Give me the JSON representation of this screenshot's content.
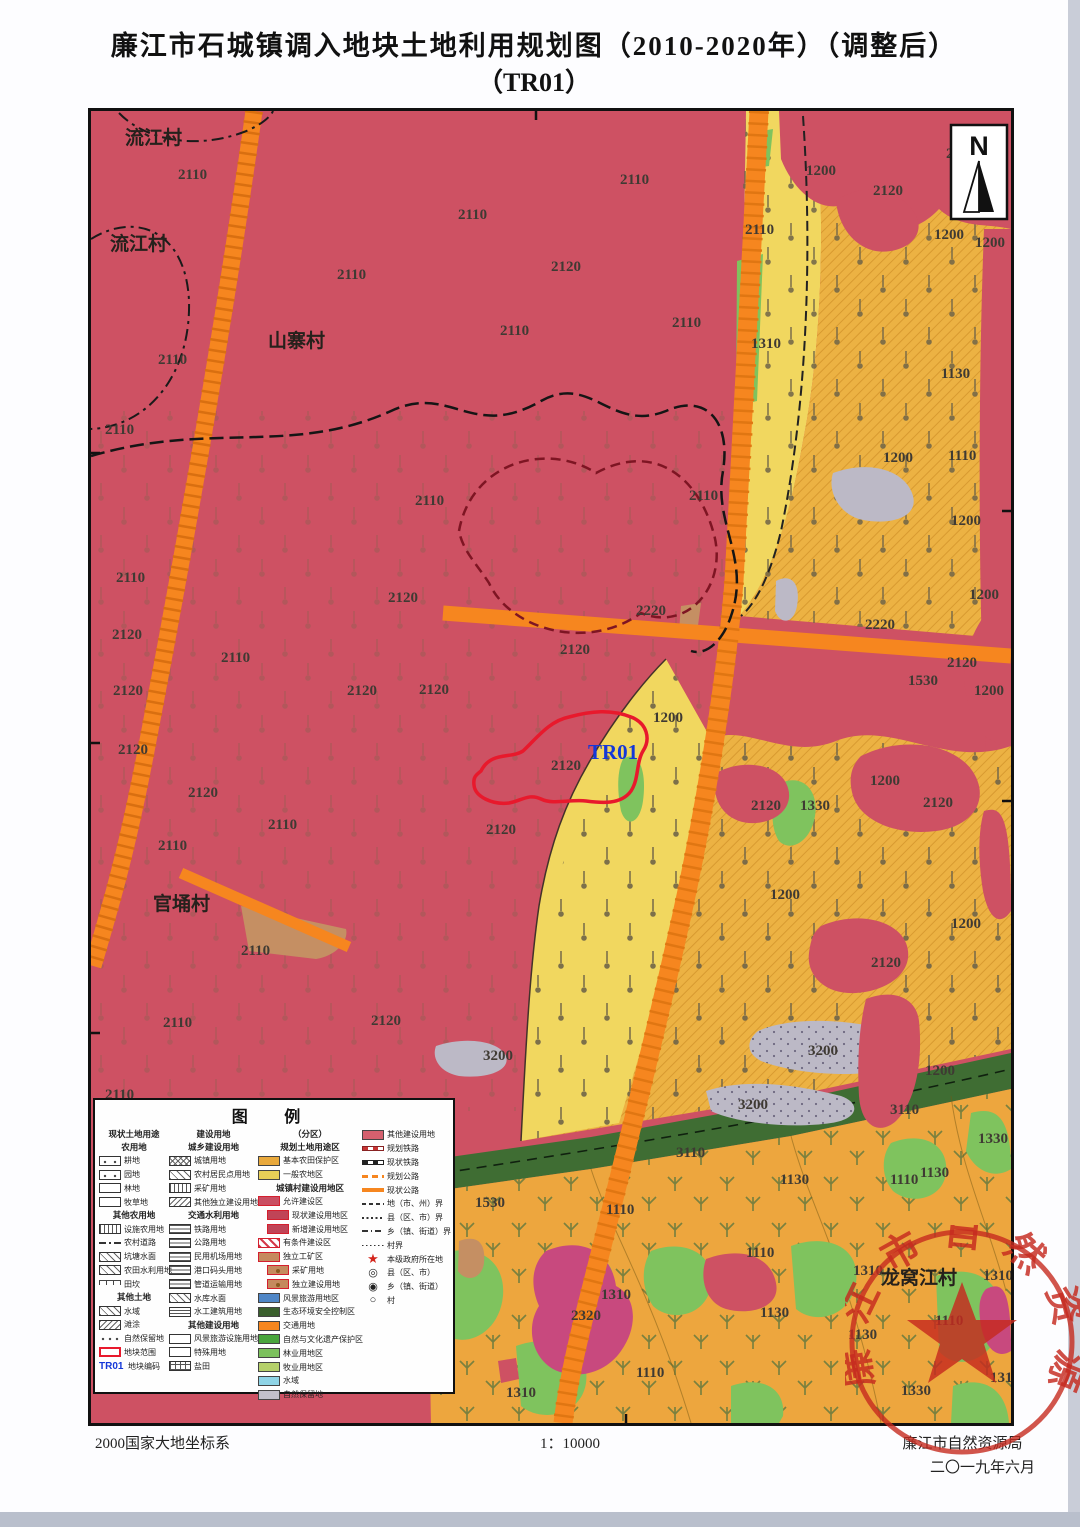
{
  "page": {
    "title_line1": "廉江市石城镇调入地块土地利用规划图（2010-2020年）（调整后）",
    "title_line2": "（TR01）"
  },
  "footer": {
    "coordinate_system": "2000国家大地坐标系",
    "scale": "1：10000",
    "agency": "廉江市自然资源局",
    "date": "二〇一九年六月"
  },
  "seal": {
    "ring_text": "廉江市自然资源局"
  },
  "north": {
    "label": "N"
  },
  "colors": {
    "base_red": "#ce5163",
    "golden": "#ecb243",
    "light_yellow": "#f1d75f",
    "bottom_gold": "#eda63e",
    "road_orange": "#f6861f",
    "green": "#7fc35e",
    "dark_green": "#3f6d33",
    "gray": "#bcb9c6",
    "magenta": "#c8497e",
    "tan": "#c58f63",
    "plot_red": "#e8192c",
    "plot_code_blue": "#1437d8",
    "seal_red": "#c62a1f"
  },
  "map": {
    "plot_code": "TR01",
    "villages": [
      {
        "t": "流江村",
        "x": 34,
        "y": 33
      },
      {
        "t": "流江村",
        "x": 19,
        "y": 139
      },
      {
        "t": "山寨村",
        "x": 177,
        "y": 236
      },
      {
        "t": "官埇村",
        "x": 62,
        "y": 799
      },
      {
        "t": "龙窝江村",
        "x": 790,
        "y": 1173
      }
    ],
    "labels": [
      {
        "t": "2110",
        "x": 87,
        "y": 68
      },
      {
        "t": "2110",
        "x": 529,
        "y": 73
      },
      {
        "t": "2110",
        "x": 367,
        "y": 108
      },
      {
        "t": "2110",
        "x": 654,
        "y": 123
      },
      {
        "t": "2110",
        "x": 246,
        "y": 168
      },
      {
        "t": "2120",
        "x": 460,
        "y": 160
      },
      {
        "t": "2110",
        "x": 409,
        "y": 224
      },
      {
        "t": "2110",
        "x": 581,
        "y": 216
      },
      {
        "t": "2110",
        "x": 67,
        "y": 253
      },
      {
        "t": "2110",
        "x": 14,
        "y": 323
      },
      {
        "t": "2110",
        "x": 324,
        "y": 394
      },
      {
        "t": "2110",
        "x": 598,
        "y": 389
      },
      {
        "t": "2110",
        "x": 25,
        "y": 471
      },
      {
        "t": "2120",
        "x": 297,
        "y": 491
      },
      {
        "t": "2110",
        "x": 130,
        "y": 551
      },
      {
        "t": "2120",
        "x": 21,
        "y": 528
      },
      {
        "t": "2120",
        "x": 22,
        "y": 584
      },
      {
        "t": "2120",
        "x": 256,
        "y": 584
      },
      {
        "t": "2120",
        "x": 328,
        "y": 583
      },
      {
        "t": "2120",
        "x": 469,
        "y": 543
      },
      {
        "t": "2120",
        "x": 27,
        "y": 643
      },
      {
        "t": "2120",
        "x": 97,
        "y": 686
      },
      {
        "t": "2120",
        "x": 460,
        "y": 659
      },
      {
        "t": "2120",
        "x": 395,
        "y": 723
      },
      {
        "t": "2110",
        "x": 177,
        "y": 718
      },
      {
        "t": "2110",
        "x": 67,
        "y": 739
      },
      {
        "t": "2110",
        "x": 150,
        "y": 844
      },
      {
        "t": "2110",
        "x": 72,
        "y": 916
      },
      {
        "t": "2120",
        "x": 280,
        "y": 914
      },
      {
        "t": "2110",
        "x": 14,
        "y": 988
      },
      {
        "t": "2220",
        "x": 545,
        "y": 504
      },
      {
        "t": "2220",
        "x": 774,
        "y": 518
      },
      {
        "t": "1200",
        "x": 715,
        "y": 64
      },
      {
        "t": "2120",
        "x": 855,
        "y": 47
      },
      {
        "t": "2120",
        "x": 782,
        "y": 84
      },
      {
        "t": "1200",
        "x": 843,
        "y": 128
      },
      {
        "t": "1200",
        "x": 884,
        "y": 136
      },
      {
        "t": "1310",
        "x": 660,
        "y": 237
      },
      {
        "t": "1130",
        "x": 850,
        "y": 267
      },
      {
        "t": "1200",
        "x": 792,
        "y": 351
      },
      {
        "t": "1110",
        "x": 857,
        "y": 349
      },
      {
        "t": "1200",
        "x": 860,
        "y": 414
      },
      {
        "t": "1200",
        "x": 878,
        "y": 488
      },
      {
        "t": "2120",
        "x": 856,
        "y": 556
      },
      {
        "t": "1530",
        "x": 817,
        "y": 574
      },
      {
        "t": "1200",
        "x": 883,
        "y": 584
      },
      {
        "t": "1200",
        "x": 562,
        "y": 611
      },
      {
        "t": "2120",
        "x": 660,
        "y": 699
      },
      {
        "t": "1330",
        "x": 709,
        "y": 699
      },
      {
        "t": "2120",
        "x": 832,
        "y": 696
      },
      {
        "t": "1200",
        "x": 779,
        "y": 674
      },
      {
        "t": "1200",
        "x": 679,
        "y": 788
      },
      {
        "t": "1200",
        "x": 860,
        "y": 817
      },
      {
        "t": "2120",
        "x": 780,
        "y": 856
      },
      {
        "t": "3200",
        "x": 717,
        "y": 944
      },
      {
        "t": "3200",
        "x": 647,
        "y": 998
      },
      {
        "t": "3200",
        "x": 392,
        "y": 949
      },
      {
        "t": "1200",
        "x": 834,
        "y": 964
      },
      {
        "t": "3110",
        "x": 799,
        "y": 1003
      },
      {
        "t": "3110",
        "x": 585,
        "y": 1046
      },
      {
        "t": "1530",
        "x": 384,
        "y": 1096
      },
      {
        "t": "1110",
        "x": 515,
        "y": 1103
      },
      {
        "t": "1130",
        "x": 689,
        "y": 1073
      },
      {
        "t": "1330",
        "x": 887,
        "y": 1032
      },
      {
        "t": "1130",
        "x": 829,
        "y": 1066
      },
      {
        "t": "1110",
        "x": 799,
        "y": 1073
      },
      {
        "t": "1110",
        "x": 655,
        "y": 1146
      },
      {
        "t": "1310",
        "x": 510,
        "y": 1188
      },
      {
        "t": "2320",
        "x": 480,
        "y": 1209
      },
      {
        "t": "1130",
        "x": 669,
        "y": 1206
      },
      {
        "t": "1110",
        "x": 545,
        "y": 1266
      },
      {
        "t": "1310",
        "x": 415,
        "y": 1286
      },
      {
        "t": "1310",
        "x": 762,
        "y": 1164
      },
      {
        "t": "1310",
        "x": 892,
        "y": 1169
      },
      {
        "t": "1110",
        "x": 844,
        "y": 1214
      },
      {
        "t": "1130",
        "x": 757,
        "y": 1228
      },
      {
        "t": "1310",
        "x": 899,
        "y": 1271
      },
      {
        "t": "1330",
        "x": 810,
        "y": 1284
      }
    ]
  },
  "legend": {
    "title": "图  例",
    "symbols": {
      "star": "★",
      "circ2": "◎",
      "circ1": "◉",
      "circ0": "○"
    },
    "columns": [
      [
        {
          "k": "h",
          "t": "现状土地用途"
        },
        {
          "k": "h",
          "t": "农用地"
        },
        {
          "k": "i",
          "t": "耕地",
          "s": "dots2"
        },
        {
          "k": "i",
          "t": "园地",
          "s": "dots2"
        },
        {
          "k": "i",
          "t": "林地",
          "s": "plain"
        },
        {
          "k": "i",
          "t": "牧草地",
          "s": "plain"
        },
        {
          "k": "h",
          "t": "其他农用地"
        },
        {
          "k": "i",
          "t": "设施农用地",
          "s": "vlines"
        },
        {
          "k": "i",
          "t": "农村道路",
          "s": "line"
        },
        {
          "k": "i",
          "t": "坑塘水面",
          "s": "diag"
        },
        {
          "k": "i",
          "t": "农田水利用地",
          "s": "diag"
        },
        {
          "k": "i",
          "t": "田坎",
          "s": "tkan"
        },
        {
          "k": "h",
          "t": "其他土地"
        },
        {
          "k": "i",
          "t": "水域",
          "s": "diag"
        },
        {
          "k": "i",
          "t": "滩涂",
          "s": "diag2"
        },
        {
          "k": "i",
          "t": "自然保留地",
          "s": "dot3"
        },
        {
          "k": "i",
          "t": "地块范围",
          "s": "plot"
        },
        {
          "k": "i",
          "t": "地块编码",
          "s": "tr01"
        }
      ],
      [
        {
          "k": "h",
          "t": "建设用地"
        },
        {
          "k": "h",
          "t": "城乡建设用地"
        },
        {
          "k": "i",
          "t": "城镇用地",
          "s": "cross"
        },
        {
          "k": "i",
          "t": "农村居民点用地",
          "s": "diag"
        },
        {
          "k": "i",
          "t": "采矿用地",
          "s": "vlines"
        },
        {
          "k": "i",
          "t": "其他独立建设用地",
          "s": "diag2"
        },
        {
          "k": "h",
          "t": "交通水利用地"
        },
        {
          "k": "i",
          "t": "铁路用地",
          "s": "hlines"
        },
        {
          "k": "i",
          "t": "公路用地",
          "s": "hlines"
        },
        {
          "k": "i",
          "t": "民用机场用地",
          "s": "hlines"
        },
        {
          "k": "i",
          "t": "港口码头用地",
          "s": "hlines"
        },
        {
          "k": "i",
          "t": "管道运输用地",
          "s": "hlines"
        },
        {
          "k": "i",
          "t": "水库水面",
          "s": "diag"
        },
        {
          "k": "i",
          "t": "水工建筑用地",
          "s": "hdash"
        },
        {
          "k": "h",
          "t": "其他建设用地"
        },
        {
          "k": "i",
          "t": "风景旅游设施用地",
          "s": "plain"
        },
        {
          "k": "i",
          "t": "特殊用地",
          "s": "plain"
        },
        {
          "k": "i",
          "t": "盐田",
          "s": "grid"
        }
      ],
      [
        {
          "k": "h",
          "t": "（分区）"
        },
        {
          "k": "h",
          "t": "规划土地用途区"
        },
        {
          "k": "i",
          "t": "基本农田保护区",
          "s": "c_e9a93c"
        },
        {
          "k": "i",
          "t": "一般农地区",
          "s": "c_e8cf57"
        },
        {
          "k": "h",
          "t": "城镇村建设用地区"
        },
        {
          "k": "i",
          "t": "允许建设区",
          "s": "allow"
        },
        {
          "k": "i",
          "t": "现状建设用地区",
          "s": "cur",
          "ind": 1
        },
        {
          "k": "i",
          "t": "新增建设用地区",
          "s": "cur",
          "ind": 1
        },
        {
          "k": "i",
          "t": "有条件建设区",
          "s": "cond"
        },
        {
          "k": "i",
          "t": "独立工矿区",
          "s": "mine0"
        },
        {
          "k": "i",
          "t": "采矿用地",
          "s": "minedot",
          "ind": 1
        },
        {
          "k": "i",
          "t": "独立建设用地",
          "s": "minedot",
          "ind": 1
        },
        {
          "k": "i",
          "t": "风景旅游用地区",
          "s": "c_4f86c6"
        },
        {
          "k": "i",
          "t": "生态环境安全控制区",
          "s": "c_3a5f2d"
        },
        {
          "k": "i",
          "t": "交通用地",
          "s": "c_f6861f"
        },
        {
          "k": "i",
          "t": "自然与文化遗产保护区",
          "s": "c_49a53c"
        },
        {
          "k": "i",
          "t": "林业用地区",
          "s": "c_7cc15d"
        },
        {
          "k": "i",
          "t": "牧业用地区",
          "s": "c_b5d06a"
        },
        {
          "k": "i",
          "t": "水域",
          "s": "c_8fd4e6"
        },
        {
          "k": "i",
          "t": "自然保留地",
          "s": "c_c2c0ca"
        }
      ],
      [
        {
          "k": "i",
          "t": "其他建设用地",
          "s": "c_d4606e"
        },
        {
          "k": "i",
          "t": "规划铁路",
          "s": "rail1"
        },
        {
          "k": "i",
          "t": "现状铁路",
          "s": "rail2"
        },
        {
          "k": "i",
          "t": "规划公路",
          "s": "road1"
        },
        {
          "k": "i",
          "t": "现状公路",
          "s": "road2"
        },
        {
          "k": "i",
          "t": "地（市、州）界",
          "s": "bnd1"
        },
        {
          "k": "i",
          "t": "县（区、市）界",
          "s": "bnd2"
        },
        {
          "k": "i",
          "t": "乡（镇、街道）界",
          "s": "bnd3"
        },
        {
          "k": "i",
          "t": "村界",
          "s": "bnd4"
        },
        {
          "k": "i",
          "t": "本级政府所在地",
          "s": "star"
        },
        {
          "k": "i",
          "t": "县（区、市）",
          "s": "circ2"
        },
        {
          "k": "i",
          "t": "乡（镇、街道）",
          "s": "circ1"
        },
        {
          "k": "i",
          "t": "村",
          "s": "circ0"
        }
      ]
    ]
  }
}
